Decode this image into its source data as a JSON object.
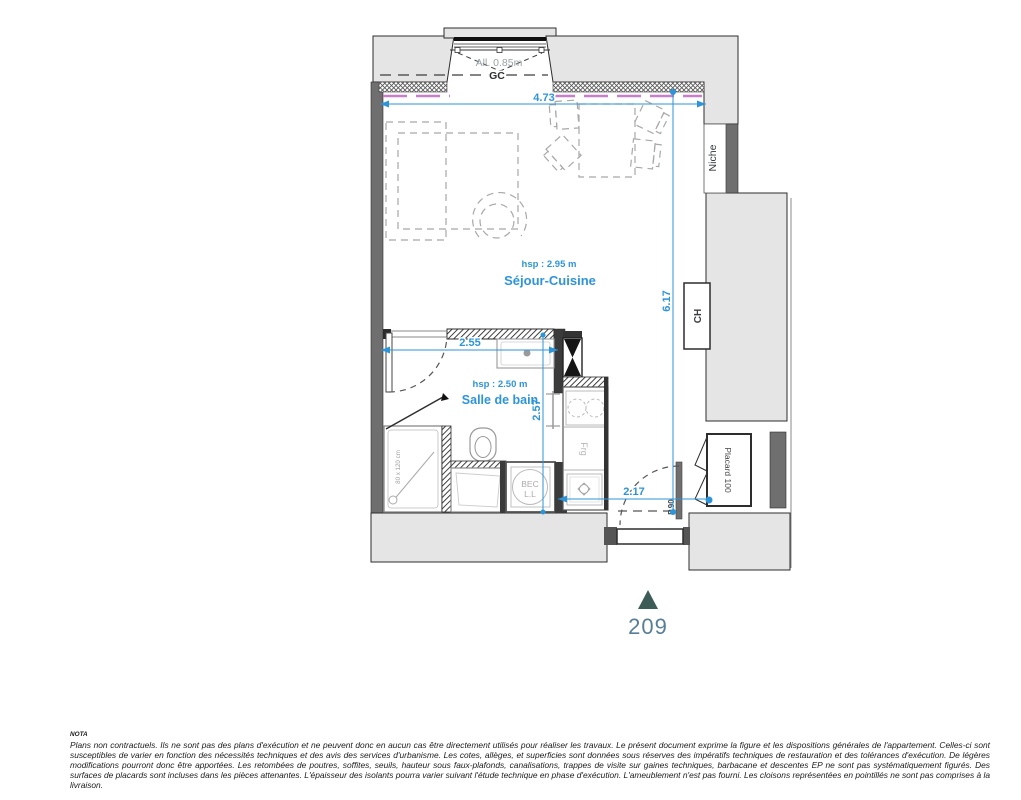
{
  "plan": {
    "window_allege": "All. 0.85m",
    "window_gc": "GC",
    "dim_width": "4.73",
    "dim_height": "6.17",
    "dim_bath_width": "2.55",
    "dim_bath_height": "2.57",
    "dim_entry": "2.17",
    "sejour_hsp": "hsp : 2.95 m",
    "sejour_name": "Séjour-Cuisine",
    "bain_hsp": "hsp : 2.50 m",
    "bain_name": "Salle de bain",
    "niche": "Niche",
    "ch": "CH",
    "placard": "Placard 100",
    "door": "P.90",
    "fridge": "Frg",
    "bec_line1": "BEC",
    "bec_line2": "L.L",
    "shower_size": "80 x 120 cm",
    "unit_number": "209",
    "colors": {
      "dimension_blue": "#2E94D8",
      "insulation_pink": "#C77FC9",
      "marker_triangle": "#3D5C57",
      "unit_number_text": "#587E97"
    }
  },
  "nota": {
    "title": "NOTA",
    "body": "Plans non contractuels. Ils ne sont pas des plans d'exécution et ne peuvent donc en aucun cas être directement utilisés pour réaliser les travaux. Le présent document exprime la figure et les dispositions générales de l'appartement. Celles-ci sont susceptibles de varier en fonction des nécessités techniques et des avis des services d'urbanisme. Les cotes, allèges, et superficies sont données sous réserves des impératifs techniques de restauration et des tolérances d'exécution. De légères modifications pourront donc être apportées. Les retombées de poutres, soffites, seuils, hauteur sous faux-plafonds, canalisations, trappes de visite sur gaines techniques, barbacane et descentes EP ne sont pas systématiquement figurés. Des surfaces de placards sont incluses dans les pièces attenantes. L'épaisseur des isolants pourra varier suivant l'étude technique en phase d'exécution. L'ameublement n'est pas fourni. Les cloisons représentées en pointillés ne sont pas comprises à la livraison."
  }
}
